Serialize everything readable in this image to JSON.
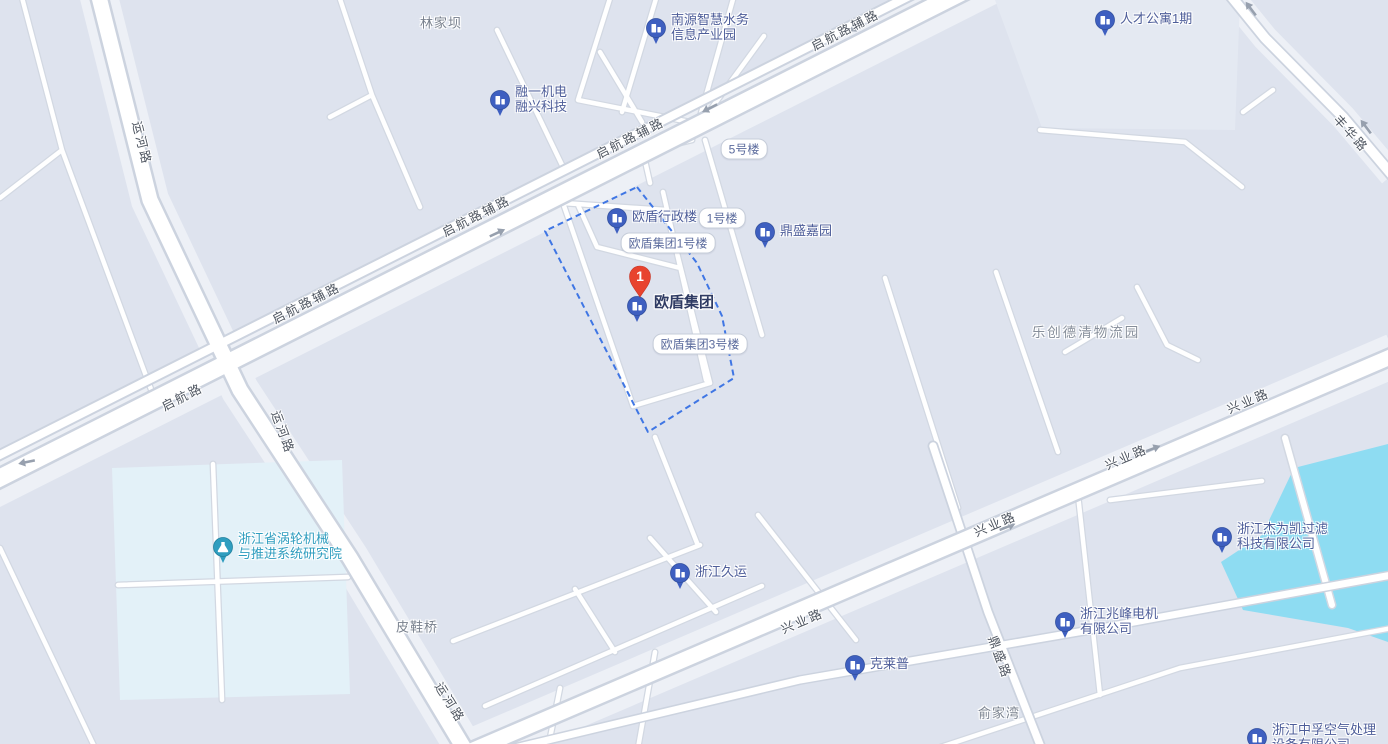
{
  "map": {
    "selected_marker": {
      "number": "1",
      "label": "欧盾集团"
    },
    "pois": [
      {
        "name": "nanyuan-industrial-park",
        "line1": "南源智慧水务",
        "line2": "信息产业园"
      },
      {
        "name": "rencai-apartment",
        "line1": "人才公寓1期"
      },
      {
        "name": "rongyi-company",
        "line1": "融一机电",
        "line2": "融兴科技"
      },
      {
        "name": "oudun-admin-building",
        "line1": "欧盾行政楼"
      },
      {
        "name": "dingsheng-jiayuan",
        "line1": "鼎盛嘉园"
      },
      {
        "name": "turbine-institute",
        "line1": "浙江省涡轮机械",
        "line2": "与推进系统研究院"
      },
      {
        "name": "zhejiang-jiuyun",
        "line1": "浙江久运"
      },
      {
        "name": "kelaipu",
        "line1": "克莱普"
      },
      {
        "name": "zhaofeng-motor",
        "line1": "浙江兆峰电机",
        "line2": "有限公司"
      },
      {
        "name": "jieweikai-filter",
        "line1": "浙江杰为凯过滤",
        "line2": "科技有限公司"
      },
      {
        "name": "zhongfu-air",
        "line1": "浙江中孚空气处理",
        "line2": "设备有限公司"
      }
    ],
    "building_bubbles": [
      {
        "label": "5号楼"
      },
      {
        "label": "1号楼"
      },
      {
        "label": "欧盾集团1号楼"
      },
      {
        "label": "欧盾集团3号楼"
      }
    ],
    "road_labels": [
      {
        "text": "启航路辅路"
      },
      {
        "text": "启航路辅路"
      },
      {
        "text": "启航路辅路"
      },
      {
        "text": "启航路辅路"
      },
      {
        "text": "启航路"
      },
      {
        "text": "运河路"
      },
      {
        "text": "运河路"
      },
      {
        "text": "运河路"
      },
      {
        "text": "兴业路"
      },
      {
        "text": "兴业路"
      },
      {
        "text": "兴业路"
      },
      {
        "text": "兴业路"
      },
      {
        "text": "鼎盛路"
      },
      {
        "text": "丰华路"
      }
    ],
    "place_labels": [
      {
        "text": "林家坝"
      },
      {
        "text": "皮鞋桥"
      },
      {
        "text": "俞家湾"
      }
    ],
    "area_labels": [
      {
        "text": "乐创德清物流园"
      }
    ],
    "colors": {
      "water": "#8edcf2",
      "poi_pin": "#3e5fc0",
      "poi_text": "#4d5d99",
      "landmark_pin": "#2f9dbf",
      "selected_marker": "#e8432e",
      "boundary": "#3f76e4",
      "road_fill": "#ffffff",
      "road_casing": "#ccd3df"
    }
  }
}
